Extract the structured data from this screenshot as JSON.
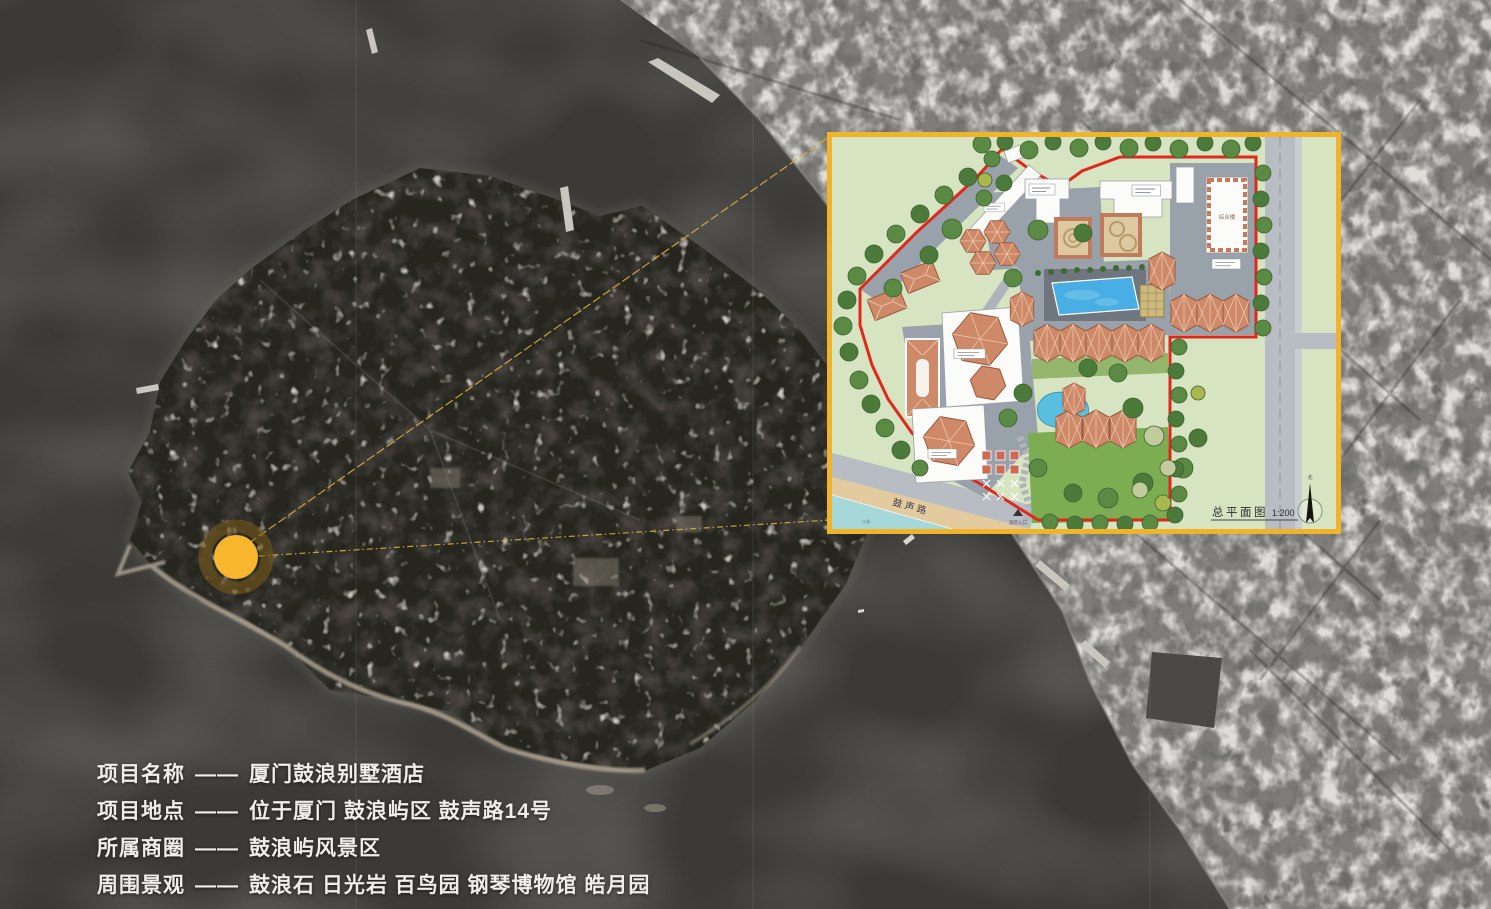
{
  "info": {
    "separator": "——",
    "rows": [
      {
        "label": "项目名称",
        "value": "厦门鼓浪别墅酒店"
      },
      {
        "label": "项目地点",
        "value": "位于厦门 鼓浪屿区 鼓声路14号"
      },
      {
        "label": "所属商圈",
        "value": "鼓浪屿风景区"
      },
      {
        "label": "周围景观",
        "value": "鼓浪石 日光岩 百鸟园 钢琴博物馆 皓月园"
      }
    ]
  },
  "site_plan": {
    "title": "总平面图",
    "scale": "1:200",
    "road": "鼓声路",
    "entrance": "酒店入口",
    "beach": "沙滩",
    "north": "北",
    "building_complex": "综合楼",
    "colors": {
      "frame_border": "#F0B42C",
      "site_boundary": "#E0291D",
      "pool_water": "#48AEE3",
      "villa_roof": "#CE8A68",
      "ground_green": "#D6E4C2"
    }
  },
  "map": {
    "marker_color": "#F8B62D",
    "marker_ring_color": "rgba(125,95,25,0.55)",
    "leader_color": "#D9AF3B",
    "water_color": "#3B3A37"
  }
}
